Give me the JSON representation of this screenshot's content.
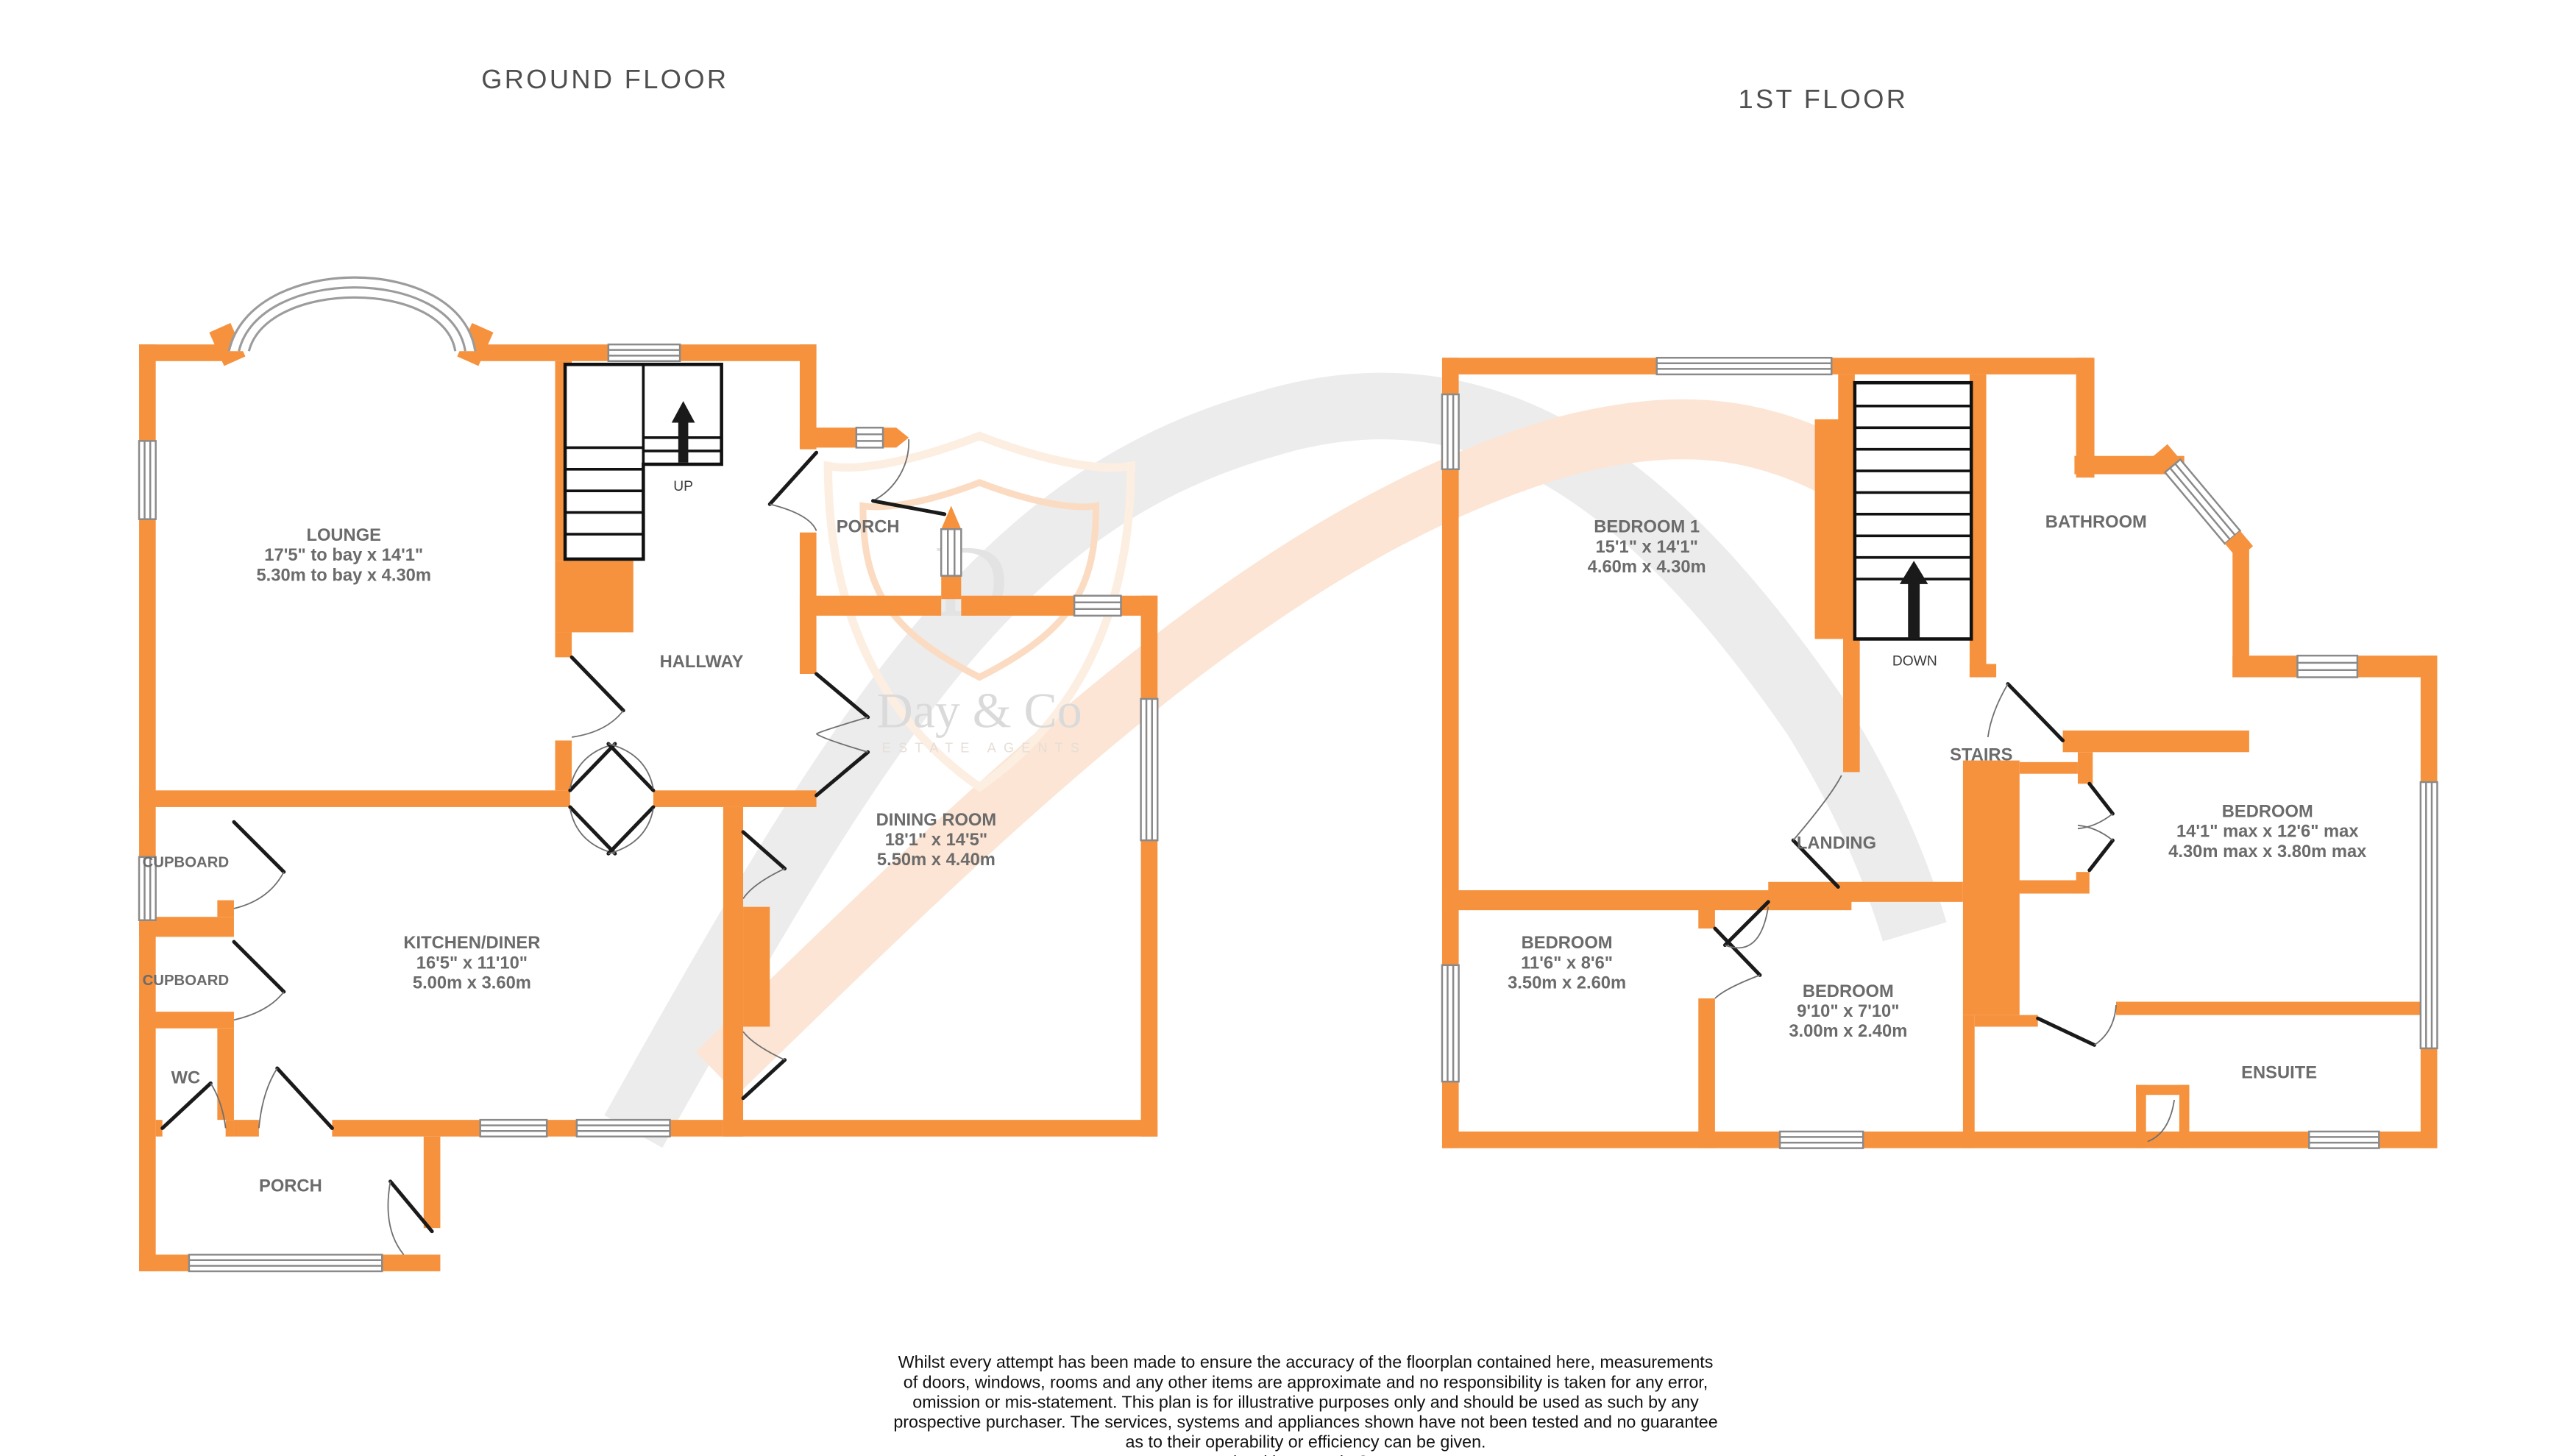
{
  "titles": {
    "ground": "GROUND FLOOR",
    "first": "1ST FLOOR"
  },
  "watermark": {
    "initial": "D",
    "brand": "Day & Co",
    "tagline": "ESTATE AGENTS",
    "shield_color": "#fbdcc2",
    "swoosh_gray": "#ececec",
    "swoosh_peach": "#fce5d4"
  },
  "colors": {
    "wall": "#F6923D",
    "label": "#6b6b6b",
    "door": "#1a1a1a"
  },
  "ground_floor": {
    "rooms": {
      "lounge": {
        "name": "LOUNGE",
        "imperial": "17'5\" to bay x 14'1\"",
        "metric": "5.30m to bay x 4.30m"
      },
      "hallway": {
        "name": "HALLWAY"
      },
      "porch_front": {
        "name": "PORCH"
      },
      "dining": {
        "name": "DINING ROOM",
        "imperial": "18'1\"  x 14'5\"",
        "metric": "5.50m  x 4.40m"
      },
      "kitchen": {
        "name": "KITCHEN/DINER",
        "imperial": "16'5\"  x 11'10\"",
        "metric": "5.00m  x 3.60m"
      },
      "cupboard1": {
        "name": "CUPBOARD"
      },
      "cupboard2": {
        "name": "CUPBOARD"
      },
      "wc": {
        "name": "WC"
      },
      "porch_rear": {
        "name": "PORCH"
      }
    },
    "stairs_label": "UP"
  },
  "first_floor": {
    "rooms": {
      "bedroom1": {
        "name": "BEDROOM 1",
        "imperial": "15'1\"  x 14'1\"",
        "metric": "4.60m  x 4.30m"
      },
      "bathroom": {
        "name": "BATHROOM"
      },
      "stairs": {
        "name": "STAIRS"
      },
      "landing": {
        "name": "LANDING"
      },
      "bedroom_left": {
        "name": "BEDROOM",
        "imperial": "11'6\"  x 8'6\"",
        "metric": "3.50m  x 2.60m"
      },
      "bedroom_middle": {
        "name": "BEDROOM",
        "imperial": "9'10\"  x 7'10\"",
        "metric": "3.00m  x 2.40m"
      },
      "bedroom_right": {
        "name": "BEDROOM",
        "imperial": "14'1\" max x 12'6\" max",
        "metric": "4.30m max x 3.80m max"
      },
      "ensuite": {
        "name": "ENSUITE"
      }
    },
    "stairs_label": "DOWN"
  },
  "footer": {
    "lines": [
      "Whilst every attempt has been made to ensure the accuracy of the floorplan contained here, measurements",
      "of doors, windows, rooms and any other items are approximate and no responsibility is taken for any error,",
      "omission or mis-statement. This plan is for illustrative purposes only and should be used as such by any",
      "prospective purchaser. The services, systems and appliances shown have not been tested and no guarantee",
      "as to their operability or efficiency can be given.",
      "Made with Metropix ©2025"
    ]
  }
}
